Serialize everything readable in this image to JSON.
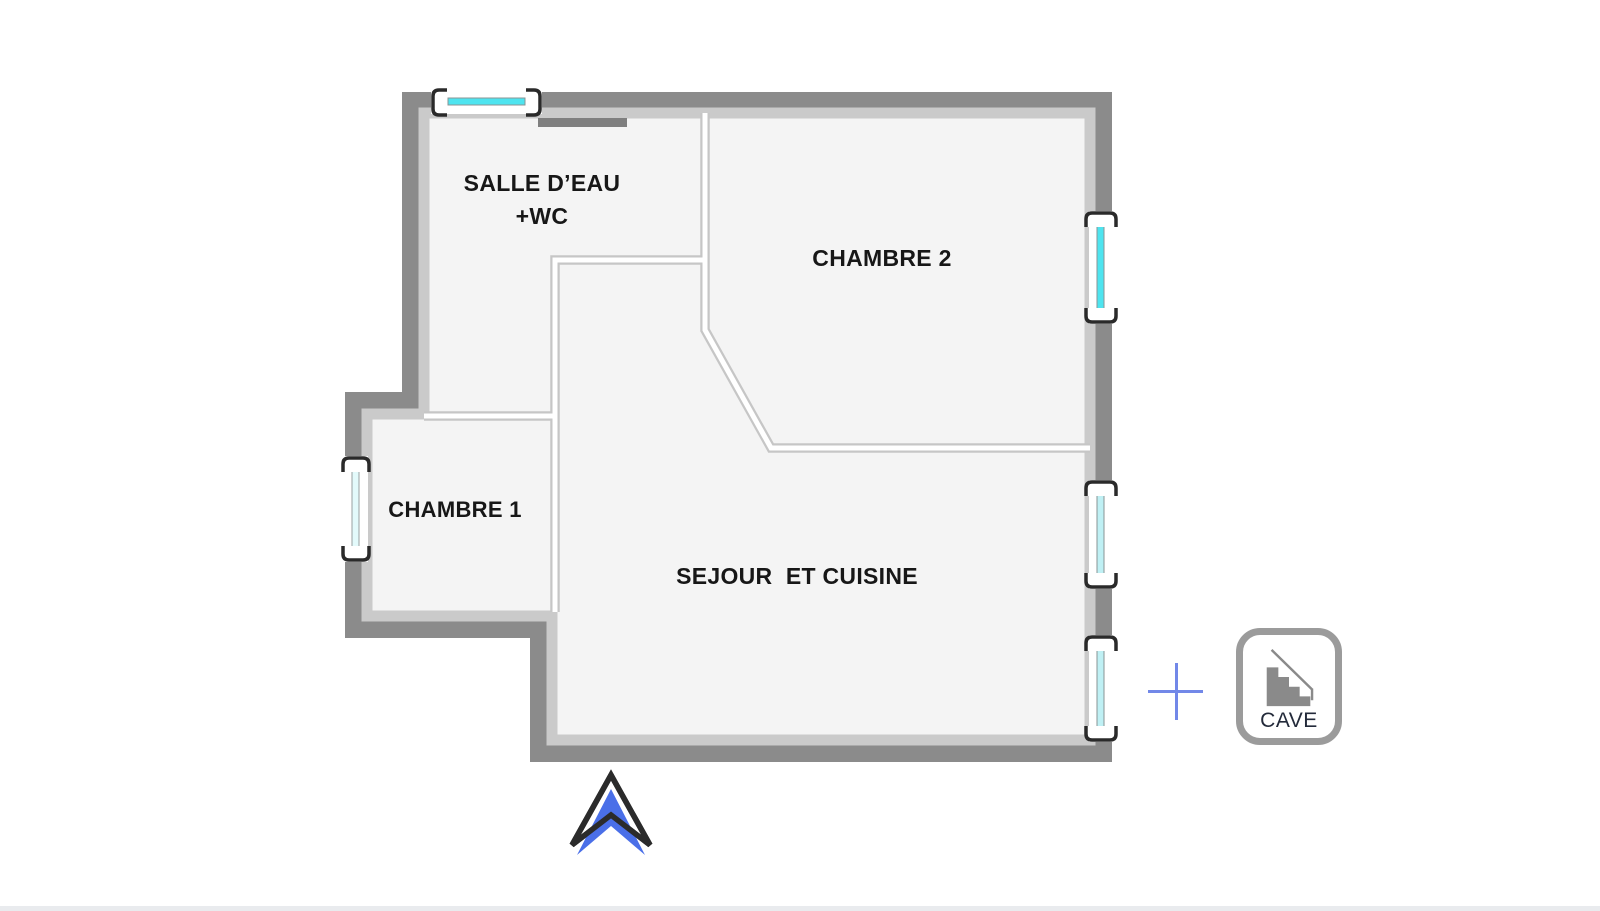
{
  "rooms": {
    "salle_eau": {
      "label": "SALLE D’EAU\n+WC"
    },
    "chambre_2": {
      "label": "CHAMBRE 2"
    },
    "chambre_1": {
      "label": "CHAMBRE 1"
    },
    "sejour_cuisine": {
      "label": "SEJOUR  ET CUISINE"
    },
    "cave": {
      "label": "CAVE"
    }
  },
  "icons": {
    "stairs": "stairs-icon",
    "north_arrow": "north-arrow-icon",
    "crosshair": "crosshair-icon",
    "windows": "window-icon"
  },
  "colors": {
    "wall": "#8b8b8b",
    "wall_liner": "#cacaca",
    "floor": "#f4f4f4",
    "partition": "#c6c6c6",
    "window_glass": "#4ee4ef",
    "window_glass_pale": "#d9f6f8",
    "window_frame": "#2a2a2a",
    "door_marker": "#7f7f7f",
    "north_arrow_fill": "#4a6fe8",
    "north_arrow_outline": "#2b2b2b",
    "crosshair": "#7288e8",
    "cave_border": "#9b9b9b",
    "stairs": "#8a8a8a",
    "label_text": "#171717",
    "cave_text": "#232a3a",
    "bottom_bar": "#e9ebee"
  }
}
